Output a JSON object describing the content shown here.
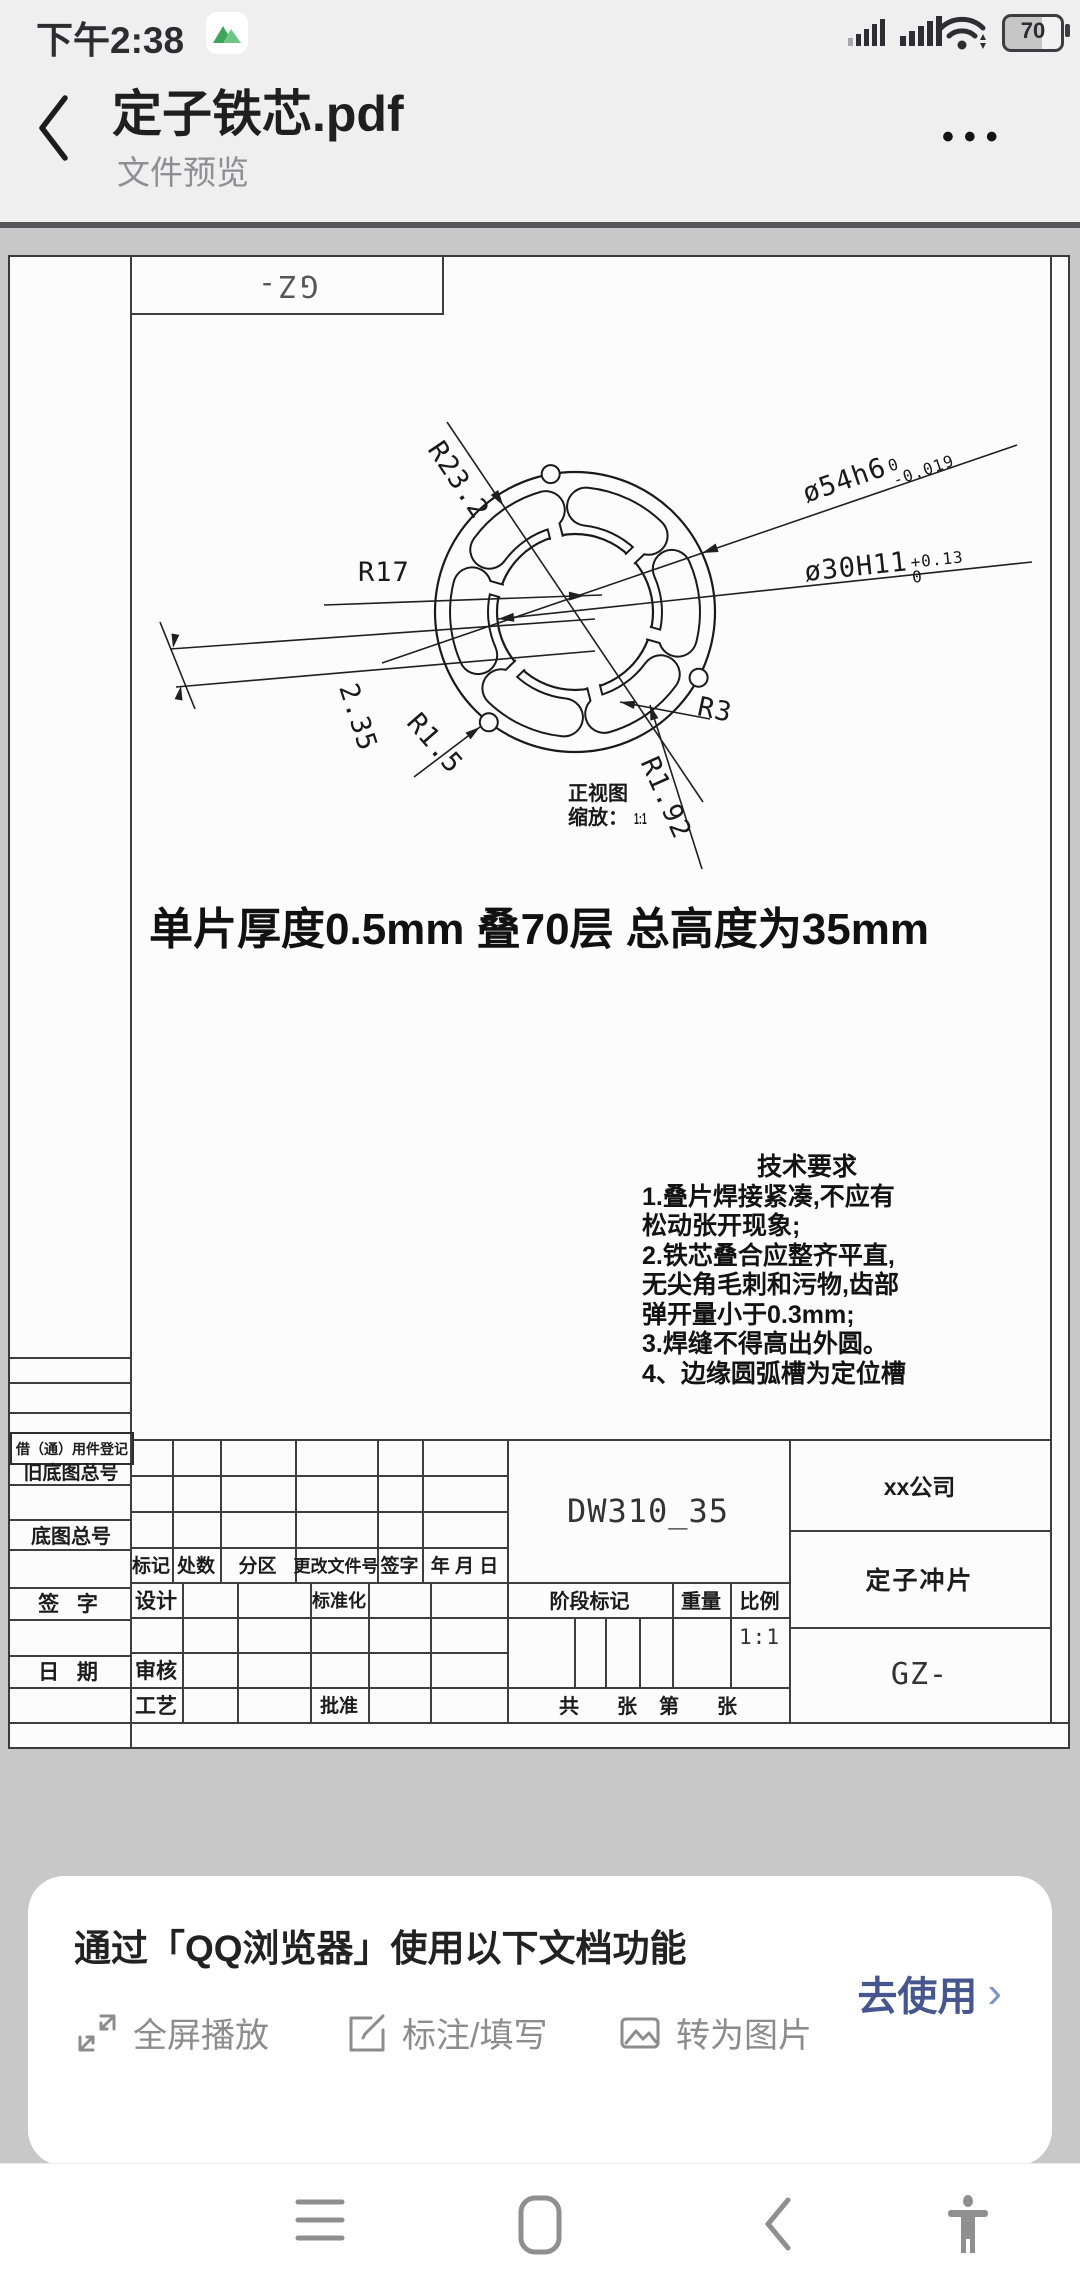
{
  "status_bar": {
    "time": "下午2:38",
    "battery_level": "70",
    "icons": [
      "app-notification-icon",
      "signal-icon",
      "wifi-icon",
      "battery-icon"
    ]
  },
  "app_bar": {
    "title": "定子铁芯.pdf",
    "subtitle": "文件预览"
  },
  "sheet": {
    "corner_label": "GZ-",
    "dims": {
      "r232": "R23.2",
      "r17": "R17",
      "d235": "2.35",
      "r15": "R1.5",
      "r192": "R1.92",
      "r3": "R3",
      "d54": {
        "main": "ø54h6",
        "sup": "0",
        "sub": "-0.019"
      },
      "d30": {
        "main": "ø30H11",
        "sup": "+0.13",
        "sub": "0"
      }
    },
    "view_label": "正视图",
    "scale_label": "缩放：",
    "scale_value": "1:1",
    "note": "单片厚度0.5mm 叠70层 总高度为35mm",
    "tech": {
      "title": "技术要求",
      "lines": [
        "1.叠片焊接紧凑,不应有",
        "松动张开现象;",
        "2.铁芯叠合应整齐平直,",
        "无尖角毛刺和污物,齿部",
        "弹开量小于0.3mm;",
        "3.焊缝不得高出外圆。",
        "4、边缘圆弧槽为定位槽"
      ]
    },
    "title_block": {
      "left_rows": [
        "借（通）用件登记",
        "旧底图总号",
        "底图总号",
        "签  字",
        "日  期"
      ],
      "rev_headers": [
        "标记",
        "处数",
        "分区",
        "更改文件号",
        "签字",
        "年 月 日"
      ],
      "roles": {
        "design": "设计",
        "standard": "标准化",
        "check": "审核",
        "process": "工艺",
        "approve": "批准"
      },
      "material": "DW310_35",
      "company": "xx公司",
      "part": "定子冲片",
      "code": "GZ-",
      "stage": "阶段标记",
      "weight": "重量",
      "scale": "比例",
      "scale_value": "1:1",
      "sheets": {
        "total": "共",
        "unit1": "张",
        "no": "第",
        "unit2": "张"
      }
    }
  },
  "banner": {
    "title": "通过「QQ浏览器」使用以下文档功能",
    "features": [
      {
        "icon": "fullscreen-icon",
        "label": "全屏播放"
      },
      {
        "icon": "annotate-icon",
        "label": "标注/填写"
      },
      {
        "icon": "image-icon",
        "label": "转为图片"
      }
    ],
    "cta": "去使用",
    "cta_color": "#45578e"
  },
  "nav": {
    "items": [
      "menu",
      "home",
      "back",
      "accessibility"
    ]
  }
}
